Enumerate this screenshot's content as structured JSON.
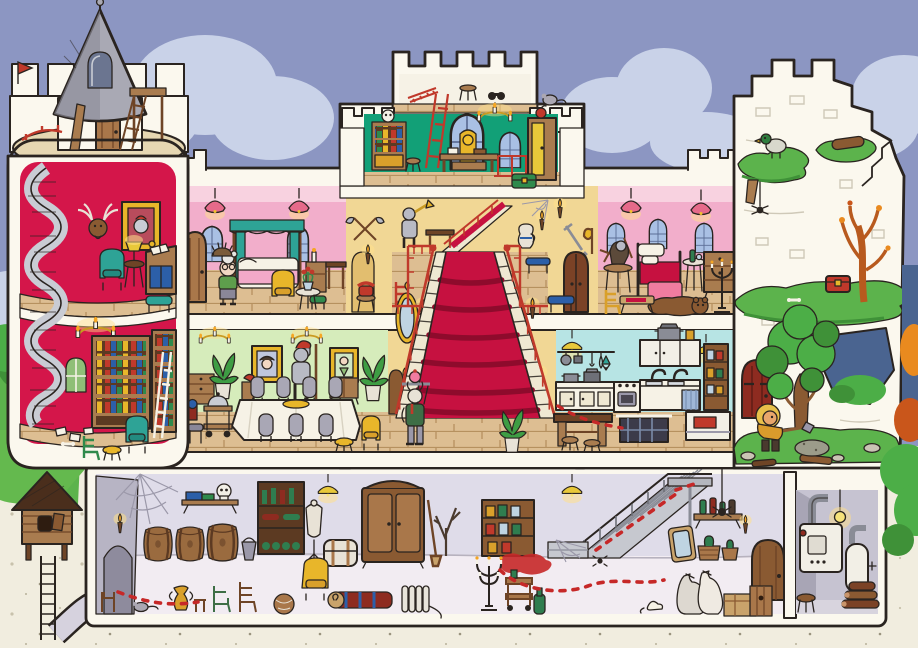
{
  "scene": {
    "title": "Castle Cutaway Seek-and-Find",
    "type": "cartoon cross-section illustration",
    "setting": "dollhouse view of a castle: turret tower, attic, throne room, two pink bedrooms, grand staircase, dining room, kitchen, ruined tower and a cellar with boiler room"
  },
  "colors": {
    "sky": "#8C96C2",
    "cloud": "#C9D2E8",
    "outline": "#2A2420",
    "cut_white": "#FBF8EE",
    "ground": "#F1EDDF",
    "tower_red": "#D4164A",
    "turret_grey": "#A9A9B4",
    "bedroom_pink": "#F2AECB",
    "bedroom_pink_light": "#F8D2E0",
    "throne_green": "#12A077",
    "dining_green": "#D6ECBB",
    "kitchen_blue": "#B7E4E4",
    "hall_tan": "#F1D795",
    "carpet_red": "#C61140",
    "wood": "#A97C4F",
    "floor_wood": "#DDBE92",
    "basement_wall": "#DFDCE9",
    "basement_grey": "#B7B4C4",
    "basement_floor": "#F2ECF2",
    "grass": "#5CB34C",
    "foliage": "#4CAE47",
    "autumn_orange": "#E98A1F",
    "teal": "#2EA396",
    "gold": "#E8B62A",
    "metal": "#A7A9B2",
    "trail_red": "#C62828",
    "night_hole": "#4A6490"
  },
  "rooms": [
    {
      "id": "turret-top",
      "name": "Tower rooftop",
      "items": [
        "grey turret roof",
        "arched roof window",
        "wooden door",
        "ladder and lookout platform",
        "leaning plank",
        "spiral-stair railing",
        "little red flag"
      ]
    },
    {
      "id": "study",
      "name": "Red tower study",
      "items": [
        "spiral staircase",
        "deer head trophy",
        "knight portrait",
        "teal wing chair",
        "lamp table",
        "writing desk with open book",
        "teal footstool"
      ]
    },
    {
      "id": "library",
      "name": "Red tower library",
      "items": [
        "candle chandelier",
        "large bookcase",
        "narrow bookcase with ladder",
        "small arched window",
        "teal armchair",
        "green chair",
        "gold stool",
        "scattered papers and bone"
      ]
    },
    {
      "id": "attic",
      "name": "Keep attic",
      "items": [
        "red ladder",
        "stool",
        "binoculars",
        "grey mouse on the battlement"
      ]
    },
    {
      "id": "throne-room",
      "name": "Throne room",
      "items": [
        "bookcase with skull",
        "stool",
        "red ladder",
        "two gothic windows",
        "gold throne",
        "council table",
        "gold chandelier",
        "wardrobe with fruit on top",
        "green chest",
        "red stair railing"
      ]
    },
    {
      "id": "bedroom-left",
      "name": "Left bedroom",
      "items": [
        "two pink pendant lamps",
        "two arched windows",
        "wooden door",
        "canopy bed",
        "night stand with candle",
        "side bench",
        "green stool",
        "yellow armchair",
        "flower table",
        "hedgehog"
      ]
    },
    {
      "id": "bedroom-right",
      "name": "Right bedroom",
      "items": [
        "two pink pendant lamps",
        "three arched windows",
        "armour seated at round table",
        "bed with red blanket",
        "wine side table",
        "dresser",
        "bear rug",
        "floor candelabra",
        "games table",
        "yellow chair"
      ]
    },
    {
      "id": "landing",
      "name": "Second-floor landing",
      "items": [
        "trumpeter armour",
        "bench",
        "jug",
        "wall torch",
        "spider web",
        "blue bench",
        "red chair",
        "red railings",
        "upper stair flight"
      ]
    },
    {
      "id": "grand-staircase",
      "name": "Grand staircase",
      "items": [
        "red carpet",
        "red balustrades",
        "four wall torches",
        "ornate mirror",
        "two side doors",
        "potted plant"
      ]
    },
    {
      "id": "dining-room",
      "name": "Dining room",
      "items": [
        "two gold chandeliers",
        "two gold-framed portraits",
        "plumed knight armour with axe",
        "sideboard",
        "two potted plants",
        "banquet table with gold platter",
        "grey high-back chairs",
        "serving trolley with cloche",
        "gold chair",
        "gold stool",
        "blue stool",
        "rolled rug"
      ]
    },
    {
      "id": "kitchen",
      "name": "Kitchen",
      "items": [
        "two yellow pendant lamps",
        "hanging pots, utensils and fish",
        "counter with cupboards",
        "stove with oven",
        "double sink with curtain",
        "wall cabinets with stock pot",
        "jar shelf",
        "prep table with stools",
        "open trapdoor with dumbwaiter cage",
        "meat chest",
        "red footprints"
      ]
    },
    {
      "id": "ruined-tower",
      "name": "Ruined tower",
      "items": [
        "broken battlements",
        "brickwork",
        "grassy ledges",
        "perched duck",
        "hanging spider",
        "fallen log",
        "broken stairs",
        "red treasure chest",
        "bare autumn tree",
        "hole in the wall",
        "red door",
        "green tree",
        "rubble, stones and planks",
        "dirt mound"
      ]
    },
    {
      "id": "cellar",
      "name": "Cellar",
      "items": [
        "tunnel wall with arch",
        "spider webs",
        "wall sconces",
        "three barrels",
        "skull-and-books shelf",
        "bottle rack",
        "bucket",
        "amphora",
        "odd chairs and stools",
        "grey mouse",
        "web basket",
        "tailor mannequin",
        "travel trunk",
        "big wardrobe",
        "broom",
        "dead branch",
        "hanging lamps",
        "jar shelf",
        "red spill",
        "yellow wing chair",
        "rolled carpet",
        "radiator",
        "floor candelabra",
        "serving trolley",
        "metal staircase",
        "leaning mirror",
        "demijohns",
        "bottle shelf",
        "hanging spider",
        "sacks",
        "crates",
        "white mouse",
        "green bottle",
        "round door"
      ]
    },
    {
      "id": "boiler-room",
      "name": "Boiler room",
      "items": [
        "bare light bulb",
        "furnace with flue",
        "water heater",
        "firewood stack",
        "stool"
      ]
    }
  ],
  "characters": [
    {
      "name": "granny",
      "location": "left bedroom",
      "look": "white bun, glasses, green cardigan, grey skirt"
    },
    {
      "name": "butler-goat",
      "location": "foot of grand staircase",
      "look": "white beard, green coat, carries a tray with a cake"
    },
    {
      "name": "treasure-digger",
      "location": "ruined tower ground",
      "look": "blond mane, mustard shirt, shovel and dirt mound"
    },
    {
      "name": "plumed-knight-armour",
      "location": "dining room"
    },
    {
      "name": "trumpeter-armour",
      "location": "second-floor landing"
    },
    {
      "name": "seated-armour",
      "location": "right bedroom"
    }
  ],
  "creatures": [
    "duck",
    "spiders",
    "grey mice",
    "white mouse",
    "hedgehog",
    "bear rug"
  ],
  "outdoor": {
    "left": "green bushes with autumn orange shrubs",
    "right": "dark treeline with autumn bushes and a green tree",
    "feature": "birdhouse on a post with a ladder and tunnel leading to the cellar"
  },
  "trail": {
    "color": "#C62828",
    "description": "dashed red footprint trail from the cellar up the metal stairs to the kitchen trapdoor"
  }
}
